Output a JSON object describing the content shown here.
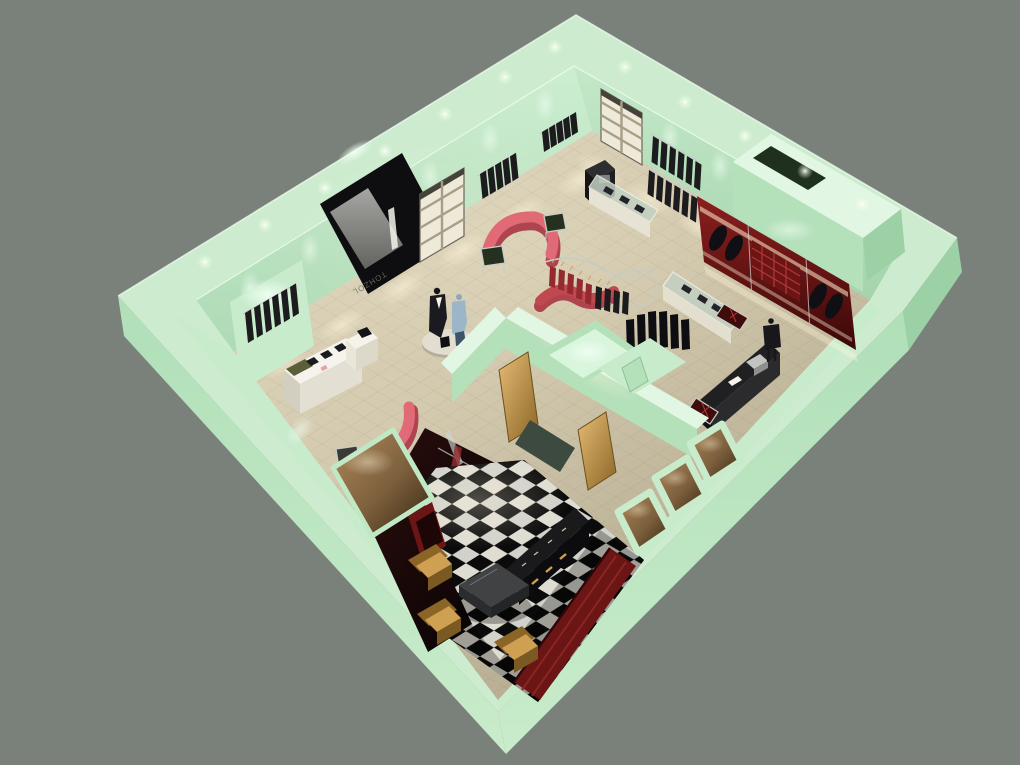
{
  "meta": {
    "title": "3D cutaway render of a clothing boutique floor plan"
  },
  "scene": {
    "background": "#7a807a",
    "entrance_sign_text": "TOHZOL",
    "palette": {
      "bg": "#7a807a",
      "wallTop": "#cdeccf",
      "wallTopBright": "#e2f7e3",
      "wallFace": "#b4e0ba",
      "wallFaceLight": "#c8ebcc",
      "wallShade": "#9cd0a5",
      "wallDark": "#7fb98c",
      "floor": "#d3c9ae",
      "floorLight": "#e4dcc3",
      "floorShade": "#b9af94",
      "glowWarm": "#fff3d6",
      "glowGreen": "#eefff1",
      "black": "#0e0e10",
      "panelDark": "#1c1c1e",
      "doorGray": "#8e8e8a",
      "maroon": "#6b1515",
      "maroonDark": "#400b0b",
      "maroonBright": "#9c2424",
      "coral": "#e06a76",
      "coralDark": "#ad4450",
      "redRack": "#c0484f",
      "garmentRed": "#942a30",
      "gold": "#cf9f52",
      "goldDark": "#8a6526",
      "tan": "#a07e52",
      "tanDark": "#3c2d1a",
      "checkerDark": "#0b0b0b",
      "checkerLight": "#dfdcd2",
      "white": "#f5f3ec",
      "shelfWhite": "#efe9da",
      "chrome": "#c6ccc6",
      "blue": "#9db5c8",
      "olive": "#5a5f38",
      "glass": "#c2d0c2"
    }
  }
}
